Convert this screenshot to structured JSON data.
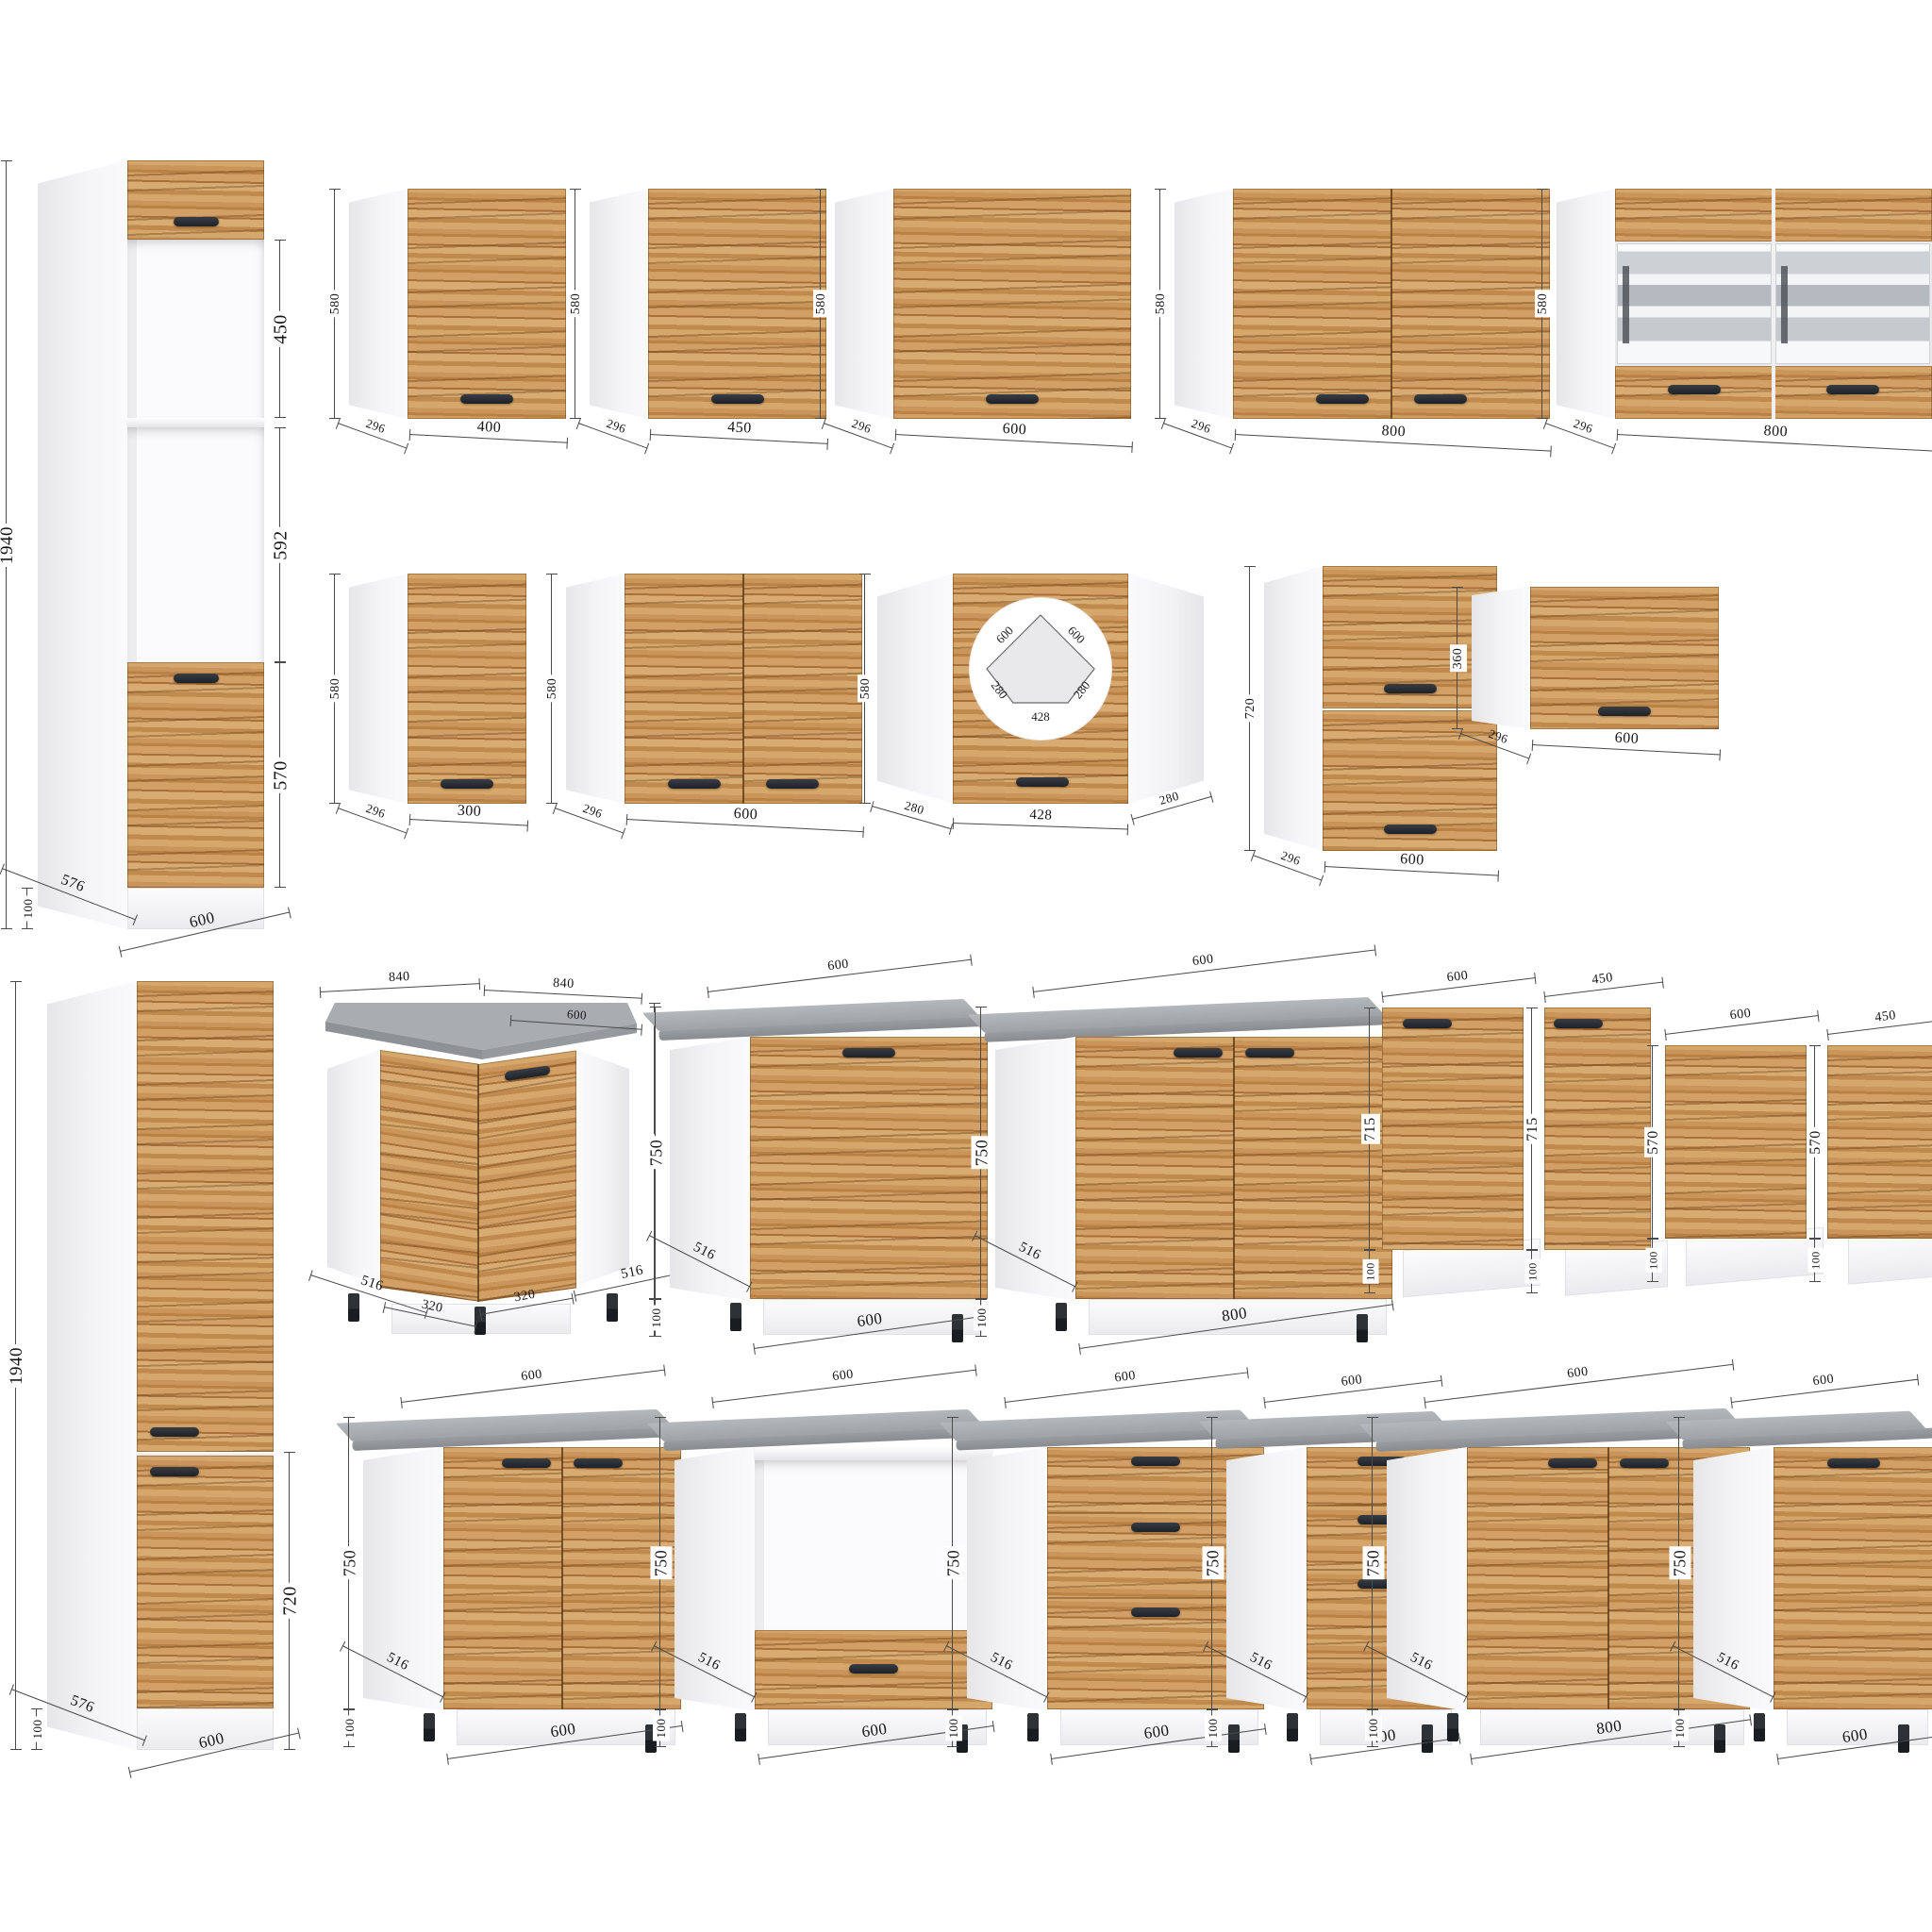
{
  "palette": {
    "wood_light": "#d6a76b",
    "wood_mid": "#c9955a",
    "wood_dark": "#a8713a",
    "carcass": "#f5f5f7",
    "countertop": "#a0a3a8",
    "countertop_edge": "#888b90",
    "handle": "#24282e",
    "dim_line": "#4a4a4a",
    "text": "#161616"
  },
  "units": "mm",
  "cabinets": [
    {
      "id": "tall-oven-600",
      "kind": "tallOven",
      "pos": [
        40,
        170
      ],
      "dims": {
        "height": "1940",
        "width": "600",
        "depth": "576",
        "plinth": "100",
        "sections": [
          "450",
          "592",
          "570"
        ]
      }
    },
    {
      "id": "wall-400",
      "kind": "wallDoor",
      "pos": [
        370,
        200
      ],
      "dims": {
        "height": "580",
        "width": "400",
        "depth": "296"
      }
    },
    {
      "id": "wall-450",
      "kind": "wallDoor",
      "pos": [
        625,
        200
      ],
      "dims": {
        "height": "580",
        "width": "450",
        "depth": "296"
      }
    },
    {
      "id": "wall-600",
      "kind": "wallDoor",
      "pos": [
        885,
        200
      ],
      "dims": {
        "height": "580",
        "width": "600",
        "depth": "296"
      }
    },
    {
      "id": "wall-800",
      "kind": "wallDoor2",
      "pos": [
        1245,
        200
      ],
      "dims": {
        "height": "580",
        "width": "800",
        "depth": "296"
      }
    },
    {
      "id": "wall-800-glass",
      "kind": "wallGlass",
      "pos": [
        1650,
        200
      ],
      "dims": {
        "height": "580",
        "width": "800",
        "depth": "296"
      }
    },
    {
      "id": "wall-300",
      "kind": "wallDoor",
      "pos": [
        370,
        608
      ],
      "dims": {
        "height": "580",
        "width": "300",
        "depth": "296"
      }
    },
    {
      "id": "wall-600-2d",
      "kind": "wallDoor2",
      "pos": [
        600,
        608
      ],
      "dims": {
        "height": "580",
        "width": "600",
        "depth": "296"
      }
    },
    {
      "id": "wall-corner",
      "kind": "wallCorner",
      "pos": [
        930,
        608
      ],
      "dims": {
        "height": "580",
        "front": "428",
        "side_left": "280",
        "side_right": "280"
      },
      "plan": {
        "wall_left": "600",
        "wall_right": "600",
        "side_left": "280",
        "side_right": "280",
        "front": "428"
      }
    },
    {
      "id": "wall-600-720",
      "kind": "wallFlap2",
      "pos": [
        1340,
        600
      ],
      "dims": {
        "height": "720",
        "width": "600",
        "depth": "296"
      }
    },
    {
      "id": "wall-600-360",
      "kind": "wallFlap",
      "pos": [
        1560,
        622
      ],
      "dims": {
        "height": "360",
        "width": "600",
        "depth": "296"
      }
    },
    {
      "id": "tall-pantry-600",
      "kind": "tallPantry",
      "pos": [
        50,
        1040
      ],
      "dims": {
        "height": "1940",
        "width": "600",
        "depth": "576",
        "plinth": "100",
        "lower": "720"
      }
    },
    {
      "id": "base-corner-840",
      "kind": "baseCorner",
      "pos": [
        345,
        1055
      ],
      "dims": {
        "top_left": "840",
        "top_right": "840",
        "top_depth": "600",
        "height": "750",
        "plinth": "100",
        "bottom": [
          "516",
          "320",
          "320",
          "516"
        ]
      }
    },
    {
      "id": "base-600",
      "kind": "baseDoor",
      "pos": [
        710,
        1065
      ],
      "dims": {
        "top": "600",
        "width": "600",
        "height": "750",
        "depth": "516",
        "plinth": "100"
      }
    },
    {
      "id": "base-800",
      "kind": "baseDoor2",
      "pos": [
        1055,
        1065
      ],
      "dims": {
        "top": "600",
        "width": "800",
        "height": "750",
        "depth": "516",
        "plinth": "100"
      }
    },
    {
      "id": "panel-600-715",
      "kind": "panel",
      "pos": [
        1465,
        1068
      ],
      "handle": true,
      "dims": {
        "width": "600",
        "height": "715",
        "plinth": "100"
      }
    },
    {
      "id": "panel-450-715",
      "kind": "panel",
      "pos": [
        1637,
        1068
      ],
      "handle": true,
      "dims": {
        "width": "450",
        "height": "715",
        "plinth": "100"
      }
    },
    {
      "id": "panel-600-570",
      "kind": "panel",
      "pos": [
        1765,
        1108
      ],
      "handle": false,
      "dims": {
        "width": "600",
        "height": "570",
        "plinth": "100"
      }
    },
    {
      "id": "panel-450-570",
      "kind": "panel",
      "pos": [
        1937,
        1108
      ],
      "handle": false,
      "dims": {
        "width": "450",
        "height": "570",
        "plinth": "100"
      }
    },
    {
      "id": "base-600-2d",
      "kind": "baseDoor2",
      "pos": [
        385,
        1500
      ],
      "dims": {
        "top": "600",
        "width": "600",
        "height": "750",
        "depth": "516",
        "plinth": "100"
      }
    },
    {
      "id": "base-600-oven",
      "kind": "baseOven",
      "pos": [
        715,
        1500
      ],
      "dims": {
        "top": "600",
        "width": "600",
        "height": "750",
        "depth": "516",
        "plinth": "100"
      }
    },
    {
      "id": "base-600-drawers",
      "kind": "baseDrawers",
      "pos": [
        1025,
        1500
      ],
      "drawers": 3,
      "dims": {
        "top": "600",
        "width": "600",
        "height": "750",
        "depth": "516",
        "plinth": "100"
      }
    },
    {
      "id": "base-400-drawers",
      "kind": "baseDrawers",
      "pos": [
        1300,
        1500
      ],
      "drawers": 3,
      "dims": {
        "top": "600",
        "width": "400",
        "height": "750",
        "depth": "516",
        "plinth": "100"
      }
    },
    {
      "id": "base-800-2d",
      "kind": "baseDoor2",
      "pos": [
        1470,
        1500
      ],
      "dims": {
        "top": "600",
        "width": "800",
        "height": "750",
        "depth": "516",
        "plinth": "100"
      }
    },
    {
      "id": "base-600-door",
      "kind": "baseDoor",
      "pos": [
        1795,
        1500
      ],
      "dims": {
        "top": "600",
        "width": "600",
        "height": "750",
        "depth": "516",
        "plinth": "100"
      }
    }
  ]
}
